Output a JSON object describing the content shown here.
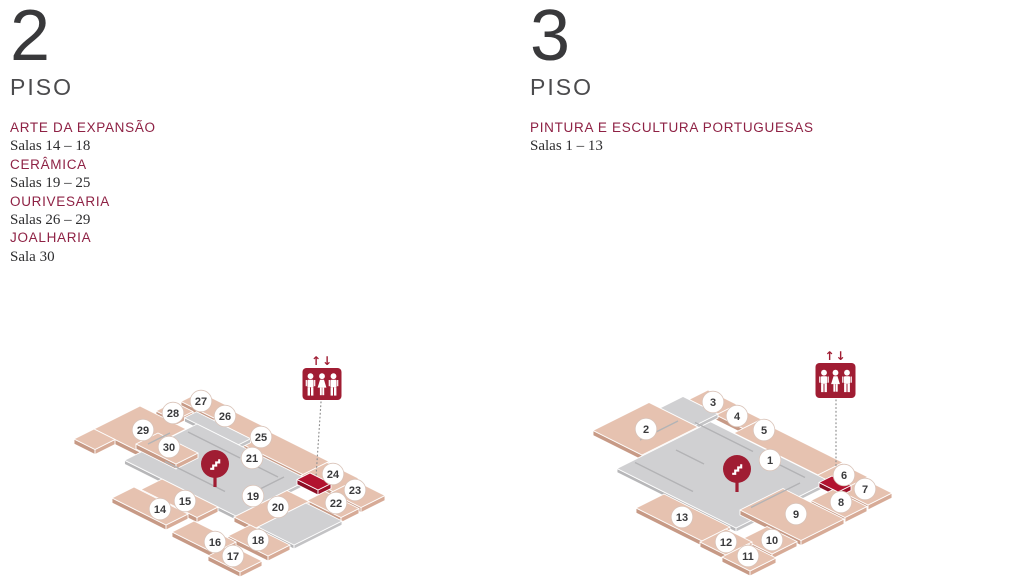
{
  "colors": {
    "pink": {
      "top": "#e6c2b0",
      "left": "#c79a86",
      "right": "#d7ab97"
    },
    "gray": {
      "top": "#d0d0d2",
      "left": "#b7b7b9",
      "right": "#c3c3c5"
    },
    "red": {
      "top": "#b2122f",
      "left": "#8c0e25",
      "right": "#9c1029"
    },
    "wall": "#b3b3b5",
    "icon_red": "#a01d33",
    "dotted": "#8f8f8f",
    "circle_fill": "#ffffff",
    "circle_stroke": "#d9c3b8",
    "number_text": "#3a3a3c"
  },
  "floors": [
    {
      "number": "2",
      "floor_label": "PISO",
      "sections": [
        {
          "name": "ARTE DA EXPANSÃO",
          "rooms": "Salas 14 – 18"
        },
        {
          "name": "CERÂMICA",
          "rooms": "Salas 19 – 25"
        },
        {
          "name": "OURIVESARIA",
          "rooms": "Salas 26 – 29"
        },
        {
          "name": "JOALHARIA",
          "rooms": "Sala 30"
        }
      ],
      "plan": {
        "origin": [
          200,
          392
        ],
        "unit": 10,
        "blocks": [
          [
            0,
            0,
            3.5,
            1.9,
            "pink"
          ],
          [
            3.5,
            0.25,
            7.2,
            2.15,
            "pink"
          ],
          [
            7.2,
            0.5,
            13.4,
            3.1,
            "pink"
          ],
          [
            13.4,
            0.7,
            16.6,
            3.3,
            "pink"
          ],
          [
            16.6,
            1.1,
            19.6,
            3.5,
            "pink"
          ],
          [
            -0.3,
            2.3,
            1.6,
            4.1,
            "pink"
          ],
          [
            1.8,
            2.15,
            7.2,
            3.35,
            "gray"
          ],
          [
            -1.6,
            4.4,
            3.0,
            9.0,
            "pink"
          ],
          [
            -1.6,
            9.0,
            0.5,
            11.0,
            "pink"
          ],
          [
            3.05,
            3.35,
            14.2,
            10.6,
            "gray"
          ],
          [
            2.0,
            6.2,
            6.0,
            8.4,
            "pink"
          ],
          [
            13.6,
            2.6,
            15.7,
            3.9,
            "red"
          ],
          [
            16.2,
            3.7,
            19.6,
            5.5,
            "pink"
          ],
          [
            14.2,
            5.5,
            16.4,
            10.8,
            "pink"
          ],
          [
            16.4,
            5.8,
            20.0,
            10.6,
            "gray"
          ],
          [
            6.8,
            10.6,
            12.4,
            12.7,
            "pink"
          ],
          [
            15.8,
            10.8,
            19.8,
            13.0,
            "pink"
          ],
          [
            6.2,
            12.8,
            11.6,
            15.0,
            "pink"
          ],
          [
            12.6,
            13.2,
            16.8,
            15.4,
            "pink"
          ],
          [
            16.8,
            13.8,
            20.0,
            16.0,
            "pink"
          ]
        ],
        "walls": [
          [
            3.4,
            4.6,
            8.6,
            4.6
          ],
          [
            9.6,
            4.6,
            12.4,
            4.6
          ],
          [
            12.7,
            4.3,
            12.7,
            6.9
          ],
          [
            5.2,
            8.7,
            11.2,
            8.7
          ],
          [
            2.6,
            5.6,
            2.6,
            7.8
          ]
        ],
        "rooms": [
          {
            "n": "27",
            "x": 201,
            "y": 401
          },
          {
            "n": "28",
            "x": 173,
            "y": 413
          },
          {
            "n": "26",
            "x": 225,
            "y": 416
          },
          {
            "n": "29",
            "x": 143,
            "y": 430
          },
          {
            "n": "30",
            "x": 169,
            "y": 447
          },
          {
            "n": "25",
            "x": 261,
            "y": 437
          },
          {
            "n": "21",
            "x": 252,
            "y": 458
          },
          {
            "n": "24",
            "x": 333,
            "y": 474
          },
          {
            "n": "23",
            "x": 355,
            "y": 490
          },
          {
            "n": "22",
            "x": 336,
            "y": 503
          },
          {
            "n": "19",
            "x": 253,
            "y": 496
          },
          {
            "n": "20",
            "x": 278,
            "y": 507
          },
          {
            "n": "15",
            "x": 185,
            "y": 501
          },
          {
            "n": "14",
            "x": 160,
            "y": 509
          },
          {
            "n": "16",
            "x": 215,
            "y": 542
          },
          {
            "n": "18",
            "x": 258,
            "y": 540
          },
          {
            "n": "17",
            "x": 233,
            "y": 556
          }
        ],
        "stairs": {
          "x": 215,
          "y": 464
        },
        "elevator": {
          "x": 302.5,
          "y": 368,
          "w": 39,
          "h": 32,
          "arrows": "↑↓"
        },
        "dotted": {
          "x1": 321,
          "y1": 402,
          "x2": 316,
          "y2": 477
        }
      }
    },
    {
      "number": "3",
      "floor_label": "PISO",
      "sections": [
        {
          "name": "PINTURA E ESCULTURA PORTUGUESAS",
          "rooms": "Salas 1 – 13"
        }
      ],
      "plan": {
        "origin": [
          708,
          390
        ],
        "unit": 10,
        "blocks": [
          [
            0,
            0,
            2.9,
            1.9,
            "pink"
          ],
          [
            2.9,
            0.25,
            5.6,
            2.1,
            "pink"
          ],
          [
            5.6,
            0.5,
            14.0,
            3.0,
            "pink"
          ],
          [
            14.0,
            0.7,
            16.7,
            3.2,
            "pink"
          ],
          [
            16.7,
            1.1,
            19.5,
            3.5,
            "pink"
          ],
          [
            -0.6,
            1.9,
            2.9,
            4.2,
            "gray"
          ],
          [
            -1.7,
            4.2,
            3.2,
            9.8,
            "pink"
          ],
          [
            3.3,
            3.05,
            15.2,
            12.4,
            "gray"
          ],
          [
            14.8,
            2.4,
            16.7,
            3.7,
            "red"
          ],
          [
            16.2,
            3.7,
            19.6,
            5.9,
            "pink"
          ],
          [
            13.6,
            6.1,
            19.7,
            10.4,
            "pink"
          ],
          [
            16.6,
            10.7,
            19.6,
            13.2,
            "pink"
          ],
          [
            8.2,
            12.6,
            14.8,
            15.4,
            "pink"
          ],
          [
            14.8,
            13.0,
            17.4,
            15.6,
            "pink"
          ],
          [
            17.4,
            13.4,
            20.2,
            16.0,
            "pink"
          ]
        ],
        "walls": [
          [
            2.6,
            3.9,
            8.4,
            3.9
          ],
          [
            9.4,
            3.9,
            13.6,
            3.9
          ],
          [
            1.6,
            4.6,
            1.6,
            8.4
          ],
          [
            13.9,
            4.7,
            13.9,
            9.6
          ],
          [
            3.6,
            10.9,
            9.4,
            10.9
          ],
          [
            4.4,
            7.6,
            7.2,
            7.6
          ]
        ],
        "rooms": [
          {
            "n": "3",
            "x": 713,
            "y": 402
          },
          {
            "n": "4",
            "x": 737,
            "y": 416
          },
          {
            "n": "2",
            "x": 646,
            "y": 429
          },
          {
            "n": "5",
            "x": 764,
            "y": 430
          },
          {
            "n": "1",
            "x": 770,
            "y": 460
          },
          {
            "n": "6",
            "x": 844,
            "y": 475
          },
          {
            "n": "7",
            "x": 865,
            "y": 489
          },
          {
            "n": "8",
            "x": 841,
            "y": 502
          },
          {
            "n": "9",
            "x": 796,
            "y": 514
          },
          {
            "n": "13",
            "x": 682,
            "y": 517
          },
          {
            "n": "10",
            "x": 772,
            "y": 540
          },
          {
            "n": "12",
            "x": 726,
            "y": 542
          },
          {
            "n": "11",
            "x": 748,
            "y": 556
          }
        ],
        "stairs": {
          "x": 737,
          "y": 469
        },
        "elevator": {
          "x": 815.5,
          "y": 363,
          "w": 40,
          "h": 35,
          "arrows": "↑↓"
        },
        "dotted": {
          "x1": 836,
          "y1": 400,
          "x2": 836,
          "y2": 475
        }
      }
    }
  ]
}
